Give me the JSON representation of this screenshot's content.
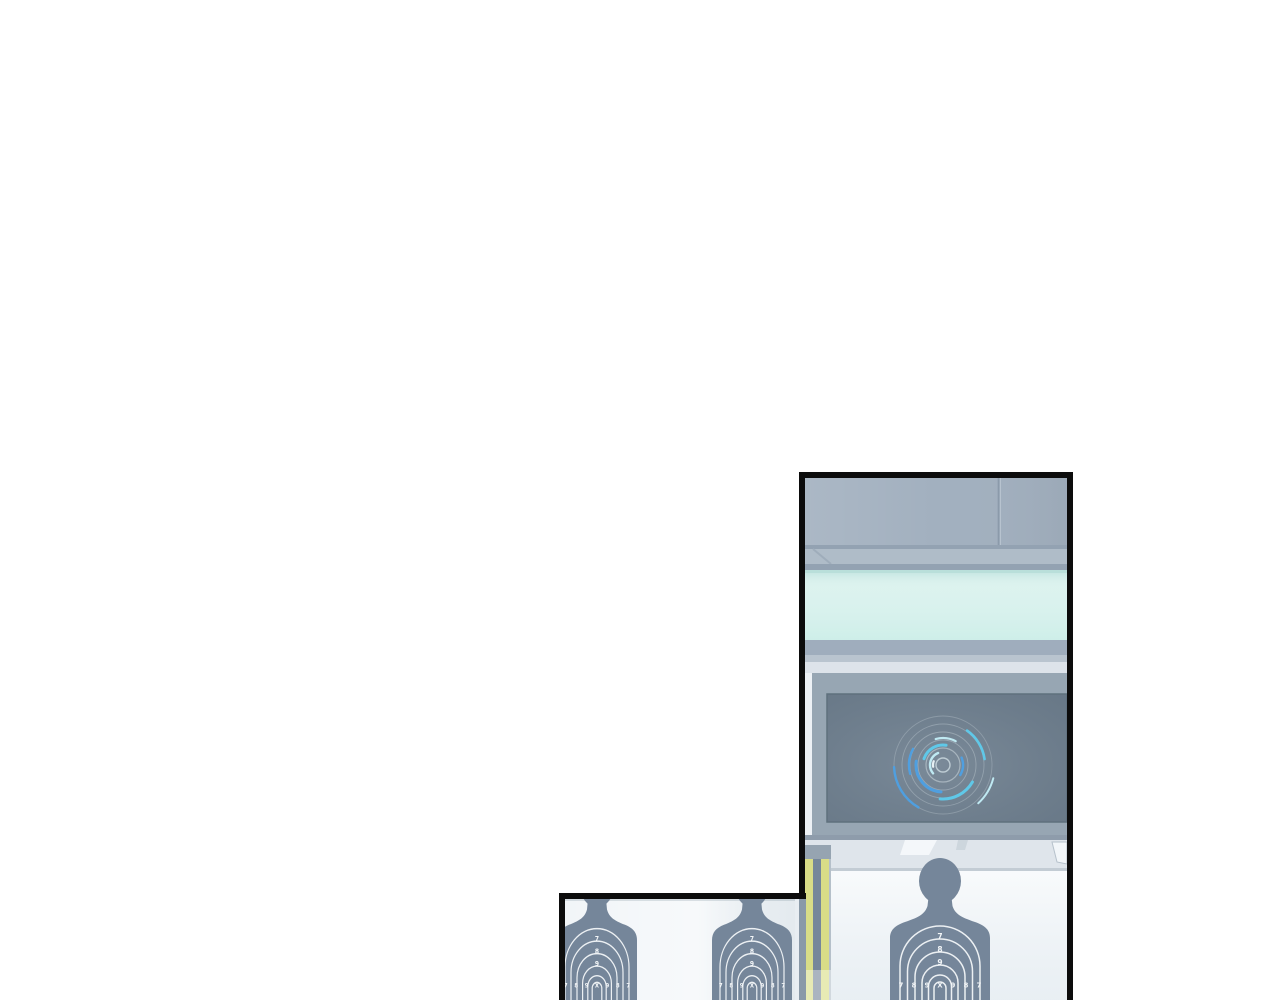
{
  "page": {
    "background": "#ffffff",
    "panel_border_color": "#0c0c0c"
  },
  "range_panel": {
    "wall_color": "#a2b0bf",
    "seam_color": "#8b9aaa",
    "ledge_color": "#afbcc8",
    "ledge_line_color": "#93a2b2",
    "glass_color": "#d4f0eb",
    "glass_edge_color": "#b9dfda",
    "band_dark": "#9fadbd",
    "band_mid": "#b9c4cf",
    "band_light": "#dde3ea",
    "bezel_color": "#97a6b3",
    "screen_color": "#6f8090",
    "screen_edge": "#5f707d",
    "beam_color": "#dfe5eb",
    "beam_highlight": "#f4f7fa",
    "beam_line": "#c3ccd4",
    "back_wall_color": "#f2f6f9",
    "glow": {
      "cyan": "#5fc8e8",
      "blue": "#4f9fe0",
      "pale": "#bfe9f2",
      "faint": "#cdd8de"
    },
    "pole": {
      "yellow": "#d9dd87",
      "gray": "#76879a",
      "cap": "#96a4b1",
      "edge": "#b5c0ca"
    }
  },
  "targets_panel": {
    "background": "#f1f5f8",
    "divider_color": "#8a99a8"
  },
  "target": {
    "silhouette_color": "#75869a",
    "ring_color": "#f3f6f8",
    "number_color": "#f3f6f8",
    "vertical_numbers": [
      "7",
      "8",
      "9"
    ],
    "score_row": [
      "7",
      "8",
      "9",
      "X",
      "9",
      "8",
      "7"
    ]
  }
}
